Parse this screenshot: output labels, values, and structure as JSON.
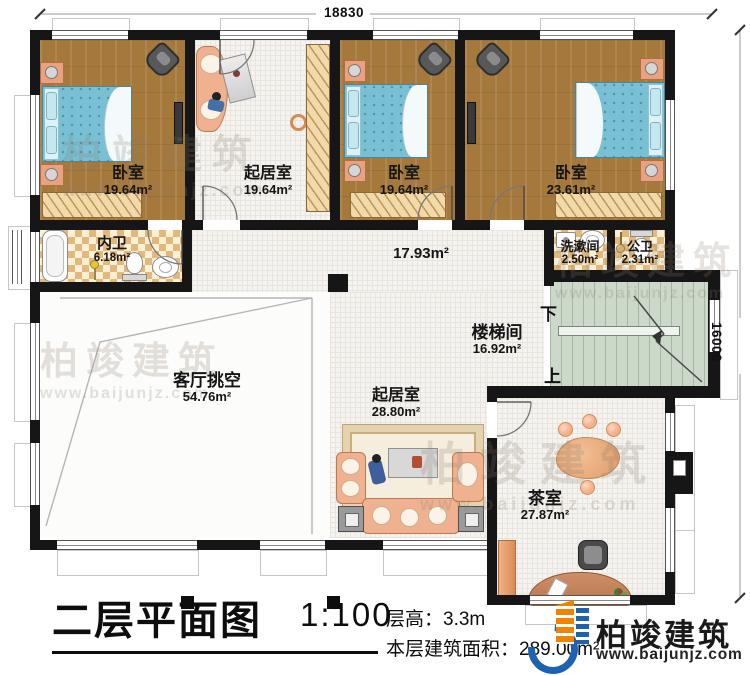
{
  "plan": {
    "dim_top": "18830",
    "dim_right": "16000",
    "stair_down": "下",
    "stair_up": "上",
    "rooms": [
      {
        "name": "卧室",
        "area": "19.64m²"
      },
      {
        "name": "起居室",
        "area": "19.64m²"
      },
      {
        "name": "卧室",
        "area": "19.64m²"
      },
      {
        "name": "卧室",
        "area": "23.61m²"
      },
      {
        "name": "内卫",
        "area": "6.18m²"
      },
      {
        "name": "洗漱间",
        "area": "2.50m²"
      },
      {
        "name": "公卫",
        "area": "2.31m²"
      },
      {
        "name": "楼梯间",
        "area": "16.92m²"
      },
      {
        "name": "客厅挑空",
        "area": "54.76m²"
      },
      {
        "name": "起居室",
        "area": "28.80m²"
      },
      {
        "name": "茶室",
        "area": "27.87m²"
      },
      {
        "name": "",
        "area": "17.93m²"
      }
    ]
  },
  "footer": {
    "title": "二层平面图",
    "scale": "1:100",
    "floor_height": "层高：3.3m",
    "floor_area": "本层建筑面积：289.00m²"
  },
  "brand": {
    "name": "柏竣建筑",
    "website": "www.baijunjz.com",
    "blue": "#1e63b0",
    "orange": "#f08300"
  },
  "watermark": {
    "text": "柏竣建筑",
    "sub": "www.baijunjz.com"
  }
}
